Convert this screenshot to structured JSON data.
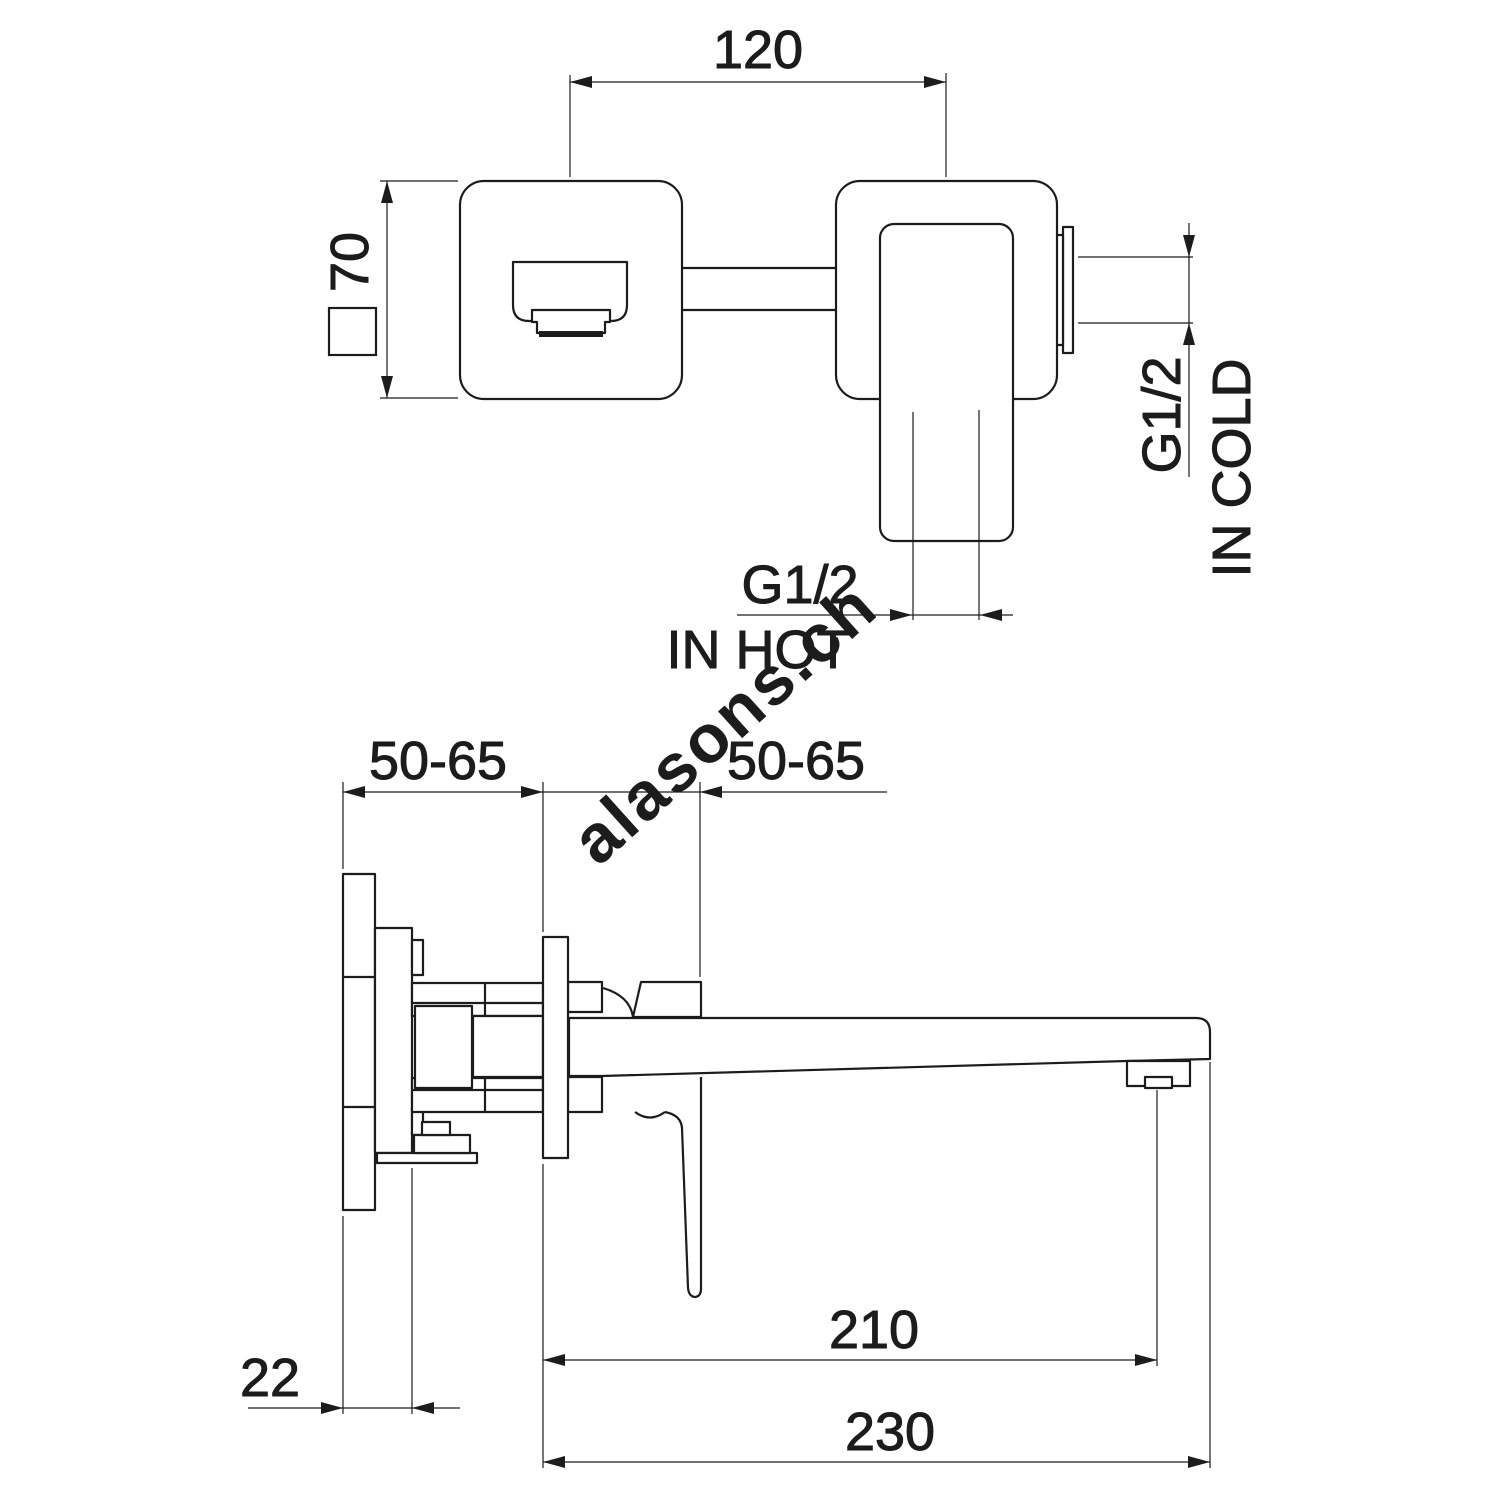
{
  "drawing": {
    "title": "wall-mounted-basin-mixer-dimension-drawing",
    "watermark": "alasons.ch",
    "front_view": {
      "dim_width": "120",
      "dim_height": "70",
      "hot_label_line1": "G1/2",
      "hot_label_line2": "IN HOT",
      "cold_label_line1": "G1/2",
      "cold_label_line2": "IN COLD"
    },
    "side_view": {
      "dim_depth_left": "50-65",
      "dim_depth_right": "50-65",
      "dim_plate_thickness": "22",
      "dim_aerator_reach": "210",
      "dim_total_reach": "230"
    },
    "colors": {
      "line": "#1c1c1c",
      "watermark": "#d7d7d7",
      "background": "#ffffff"
    }
  }
}
